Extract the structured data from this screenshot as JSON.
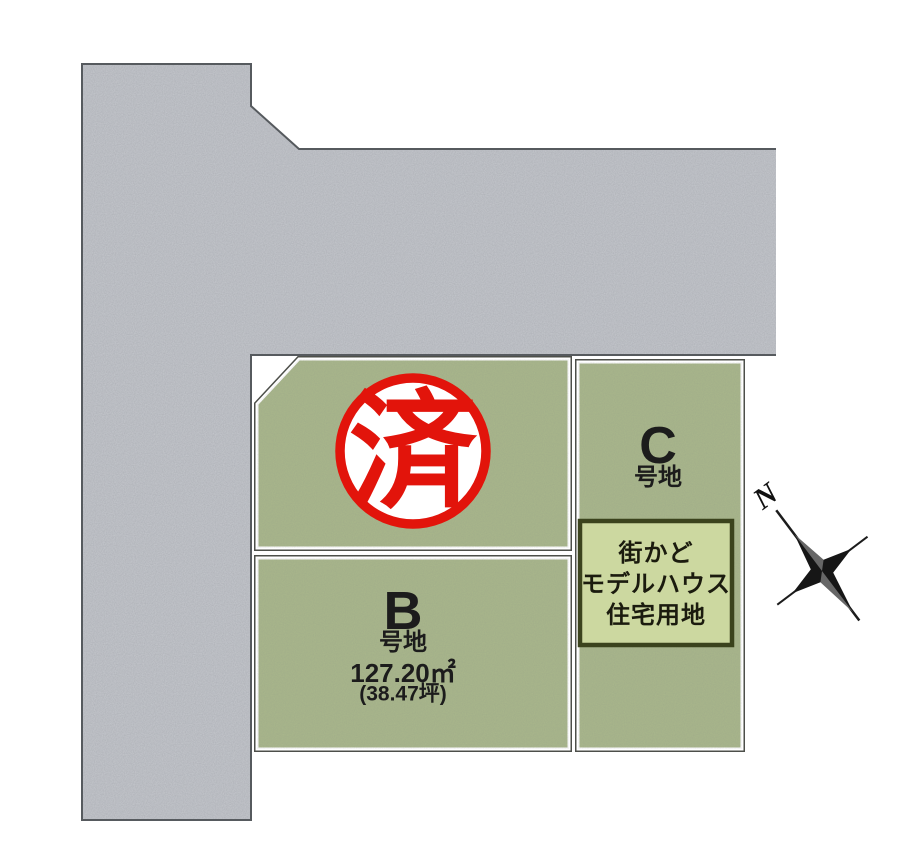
{
  "site_plan": {
    "background": "#ffffff",
    "road": {
      "fill": "#c6c9ce",
      "outline": "#565a5e"
    },
    "plots": {
      "fill": "#aab88c",
      "outline": "#4d4f4a",
      "b": {
        "id": "B",
        "unit_label": "号地",
        "area_sqm": "127.20㎡",
        "area_tsubo": "(38.47坪)"
      },
      "c": {
        "id": "C",
        "unit_label": "号地"
      }
    },
    "model_house_sign": {
      "lines": [
        "街かど",
        "モデルハウス",
        "住宅用地"
      ],
      "fill": "#ccd8a0",
      "border": "#3b431d"
    },
    "sold_stamp": {
      "label": "済",
      "color": "#e2140b"
    },
    "compass": {
      "north_label": "N"
    }
  }
}
